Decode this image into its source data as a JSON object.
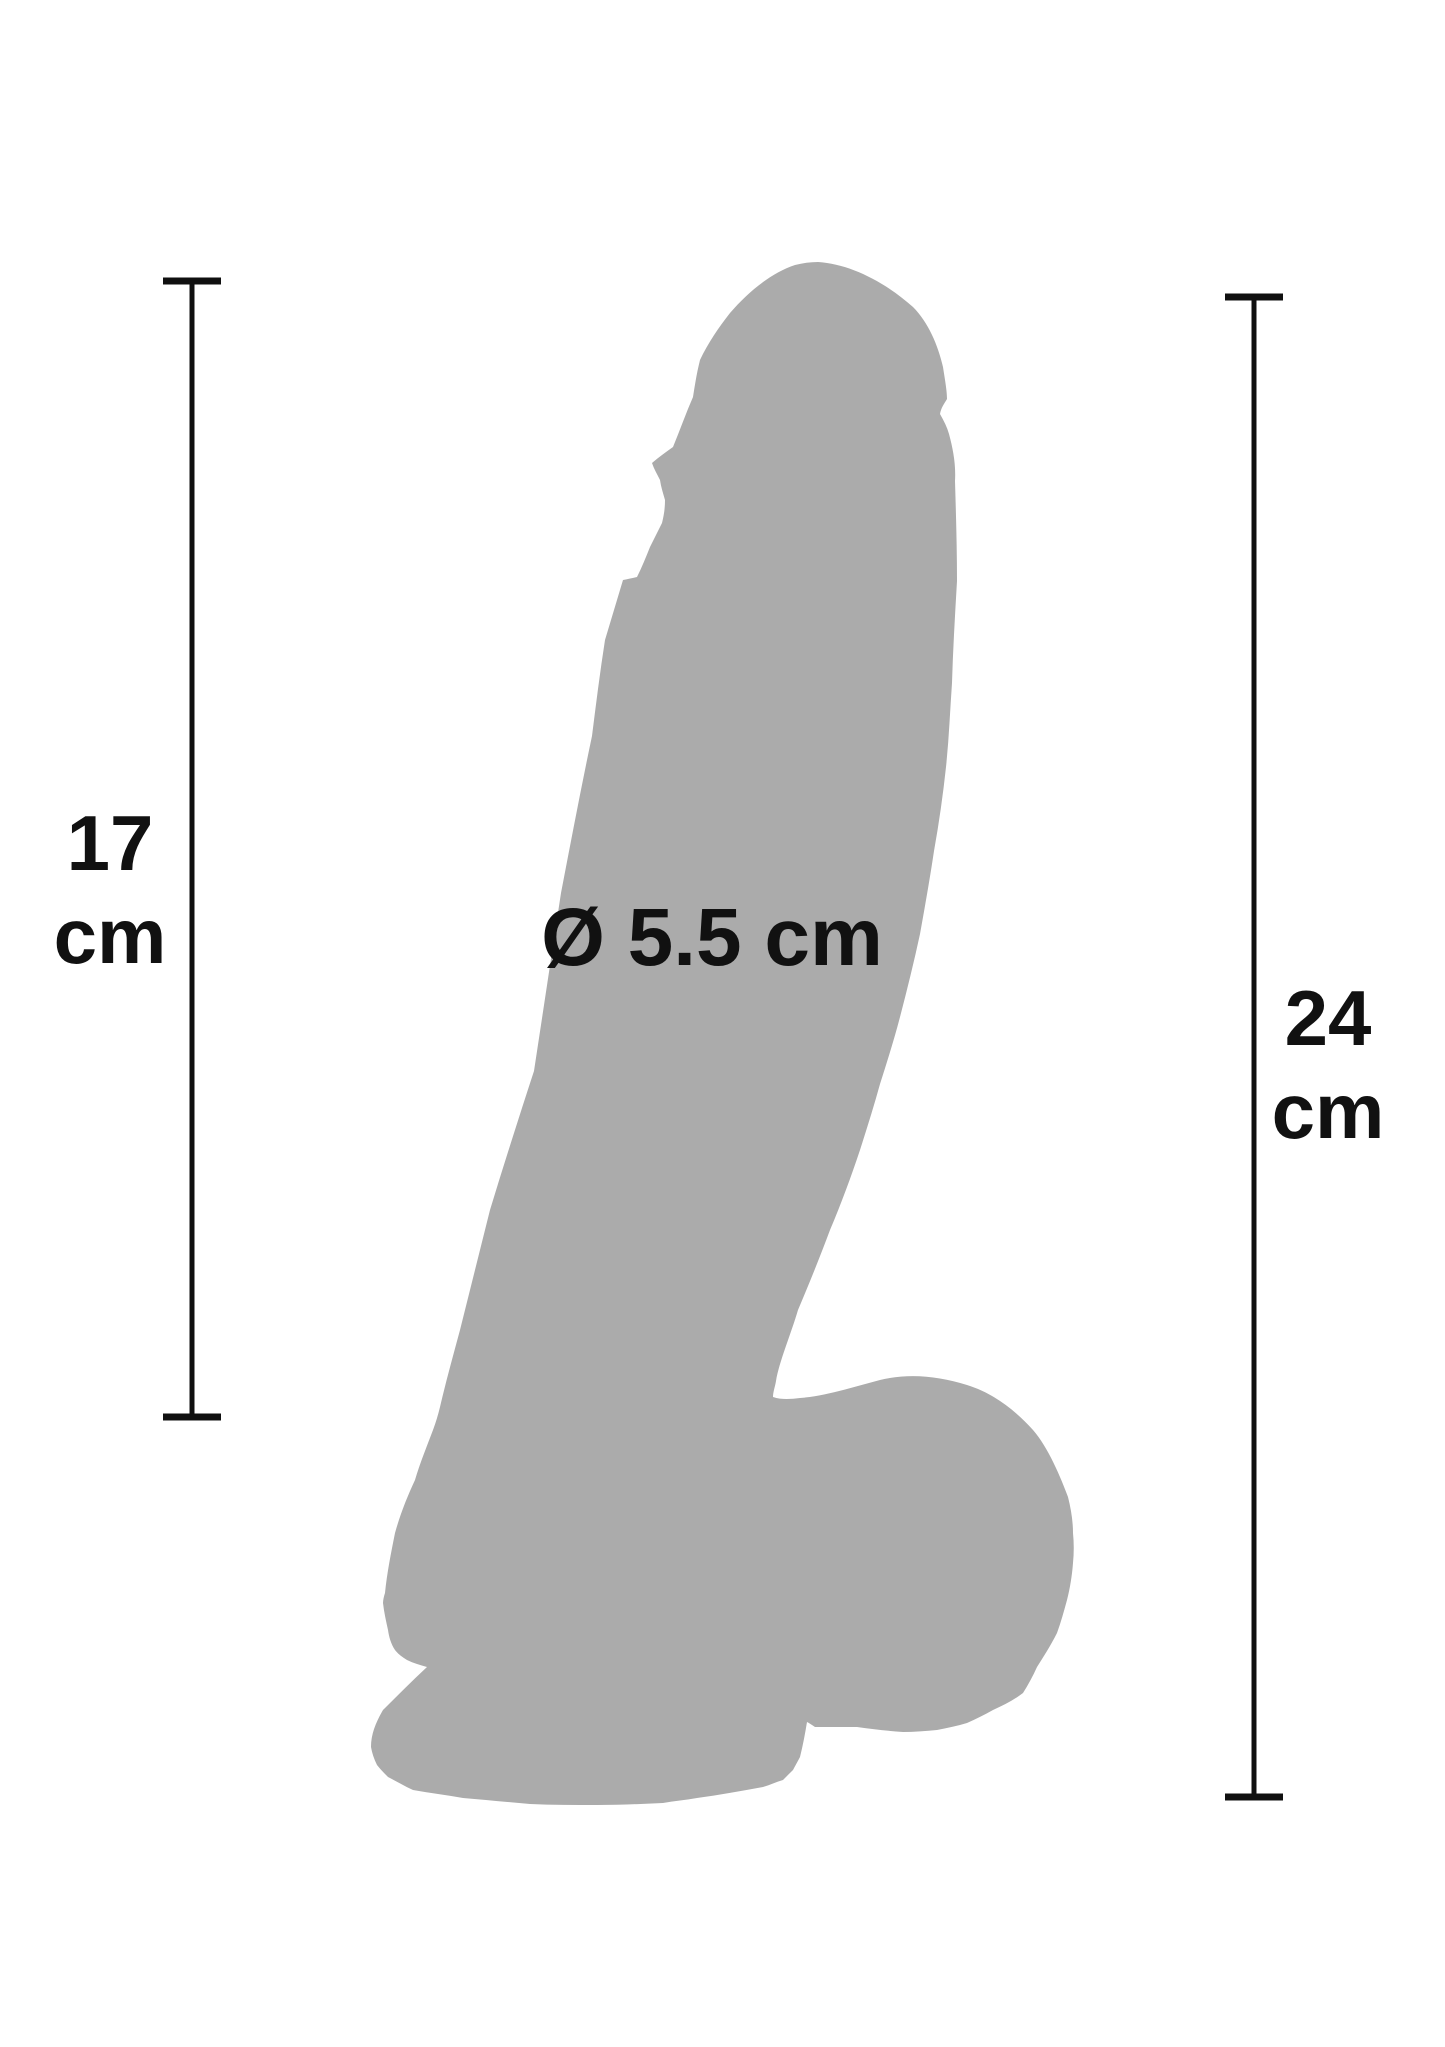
{
  "figure": {
    "title": "product dimension diagram",
    "silhouette_color": "#ababab",
    "line_color": "#101010",
    "text_color": "#111111",
    "background_color": "#ffffff",
    "measurements": {
      "left": {
        "value": "17",
        "unit": "cm"
      },
      "right": {
        "value": "24",
        "unit": "cm"
      },
      "diameter": {
        "label": "Ø 5.5 cm"
      }
    }
  }
}
